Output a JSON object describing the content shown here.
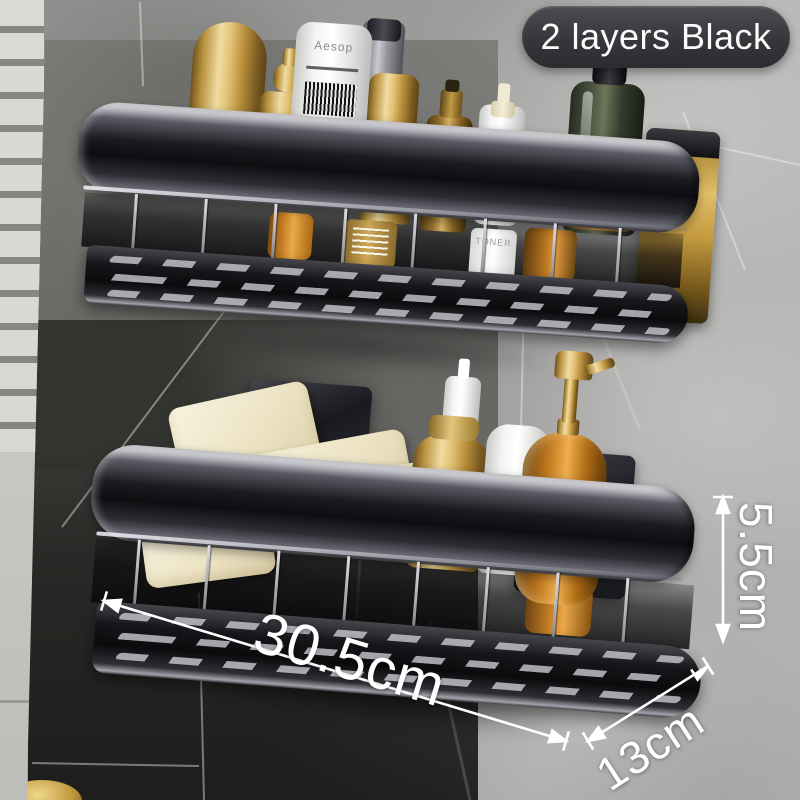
{
  "badge": {
    "label": "2 layers Black"
  },
  "annotations": {
    "width": "30.5cm",
    "depth": "13cm",
    "height": "5.5cm"
  },
  "products": {
    "tube_brand": "Aesop",
    "soap_box_label": "ARGAN",
    "toner_label": "TONER",
    "top_shelf_items": [
      "gold dome bottle",
      "gold pump dispenser",
      "Aesop tube",
      "gray tube",
      "gold slim bottle",
      "brass neck bottle",
      "cream pump bottle",
      "dark glass bottle",
      "toner bottle",
      "amber bottles"
    ],
    "bottom_shelf_items": [
      "cream soap bar",
      "cream soap bar",
      "ARGAN soap box",
      "cream soap bar",
      "white tube",
      "gold bottle",
      "white bottle with gold band",
      "amber glass pump dispenser"
    ]
  },
  "colors": {
    "badge_bg": "#3a3a3c",
    "badge_text": "#fafafa",
    "annotation_text": "#ffffff",
    "shelf_frame": "#17171b",
    "gold": "#c9a14e",
    "cream_soap": "#efe6c8",
    "amber": "#c07a22",
    "wall_gray": "#9a9a98",
    "wall_dark": "#303030",
    "tile_strip": "#cfcfcb"
  }
}
